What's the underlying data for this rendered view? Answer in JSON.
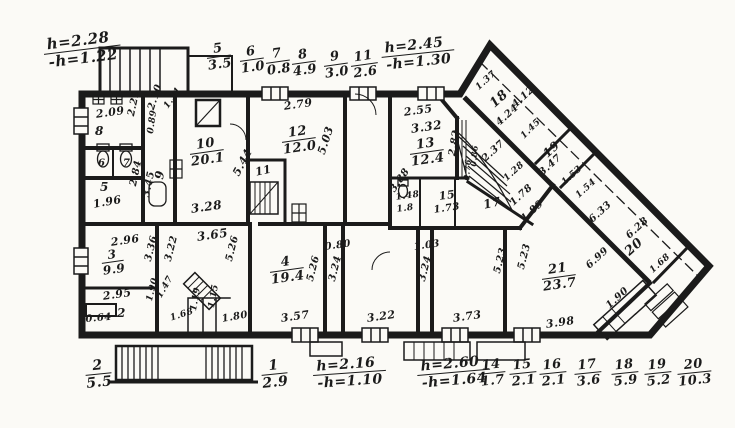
{
  "drawing": {
    "type": "apartment-floor-plan",
    "ink": "#1b1b1b",
    "paper": "#fbfaf6"
  },
  "room_fractions": [
    {
      "n": "5",
      "d": "3.5",
      "x": 205,
      "y": 44,
      "r": -8,
      "s": 13,
      "name": "legend-room-5"
    },
    {
      "n": "6",
      "d": "1.0",
      "x": 238,
      "y": 47,
      "r": -8,
      "s": 13,
      "name": "legend-room-6"
    },
    {
      "n": "7",
      "d": "0.8",
      "x": 264,
      "y": 49,
      "r": -8,
      "s": 13,
      "name": "legend-room-7"
    },
    {
      "n": "8",
      "d": "4.9",
      "x": 290,
      "y": 50,
      "r": -8,
      "s": 13,
      "name": "legend-room-8"
    },
    {
      "n": "9",
      "d": "3.0",
      "x": 322,
      "y": 52,
      "r": -8,
      "s": 13,
      "name": "legend-room-9"
    },
    {
      "n": "11",
      "d": "2.6",
      "x": 349,
      "y": 52,
      "r": -8,
      "s": 13,
      "name": "legend-room-11"
    },
    {
      "n": "h=2.28",
      "d": "-h=1.22",
      "x": 42,
      "y": 38,
      "r": -7,
      "s": 15,
      "cls": "h",
      "name": "height-note-top-left"
    },
    {
      "n": "h=2.45",
      "d": "-h=1.30",
      "x": 380,
      "y": 42,
      "r": -6,
      "s": 14,
      "cls": "h",
      "name": "height-note-top-right"
    },
    {
      "n": "2",
      "d": "5.5",
      "x": 84,
      "y": 360,
      "r": -6,
      "s": 14,
      "name": "legend-room-2"
    },
    {
      "n": "1",
      "d": "2.9",
      "x": 260,
      "y": 360,
      "r": -6,
      "s": 14,
      "name": "legend-room-1"
    },
    {
      "n": "h=2.16",
      "d": "-h=1.10",
      "x": 312,
      "y": 360,
      "r": -4,
      "s": 14,
      "cls": "h",
      "name": "height-note-bottom-left"
    },
    {
      "n": "h=2.60",
      "d": "-h=1.64",
      "x": 416,
      "y": 360,
      "r": -5,
      "s": 14,
      "cls": "h",
      "name": "height-note-bottom-right"
    },
    {
      "n": "14",
      "d": "1.7",
      "x": 477,
      "y": 360,
      "r": -6,
      "s": 13,
      "name": "legend-room-14"
    },
    {
      "n": "15",
      "d": "2.1",
      "x": 508,
      "y": 360,
      "r": -6,
      "s": 13,
      "name": "legend-room-15"
    },
    {
      "n": "16",
      "d": "2.1",
      "x": 538,
      "y": 360,
      "r": -6,
      "s": 13,
      "name": "legend-room-16"
    },
    {
      "n": "17",
      "d": "3.6",
      "x": 573,
      "y": 360,
      "r": -6,
      "s": 13,
      "name": "legend-room-17"
    },
    {
      "n": "18",
      "d": "5.9",
      "x": 610,
      "y": 360,
      "r": -6,
      "s": 13,
      "name": "legend-room-18"
    },
    {
      "n": "19",
      "d": "5.2",
      "x": 643,
      "y": 360,
      "r": -6,
      "s": 13,
      "name": "legend-room-19"
    },
    {
      "n": "20",
      "d": "10.3",
      "x": 676,
      "y": 360,
      "r": -6,
      "s": 13,
      "name": "legend-room-20"
    },
    {
      "n": "10",
      "d": "20.1",
      "x": 188,
      "y": 140,
      "r": -8,
      "s": 13,
      "name": "room-10-area"
    },
    {
      "n": "12",
      "d": "12.0",
      "x": 280,
      "y": 128,
      "r": -8,
      "s": 13,
      "name": "room-12-area"
    },
    {
      "n": "13",
      "d": "12.4",
      "x": 408,
      "y": 140,
      "r": -8,
      "s": 13,
      "name": "room-13-area"
    },
    {
      "n": "3",
      "d": "9.9",
      "x": 100,
      "y": 250,
      "r": -8,
      "s": 12,
      "name": "room-3-area"
    },
    {
      "n": "4",
      "d": "19.4",
      "x": 268,
      "y": 258,
      "r": -8,
      "s": 13,
      "name": "room-4-area"
    },
    {
      "n": "21",
      "d": "23.7",
      "x": 540,
      "y": 265,
      "r": -8,
      "s": 13,
      "name": "room-21-area"
    }
  ],
  "dim_labels": [
    {
      "t": "2.09",
      "x": 95,
      "y": 108,
      "r": -8,
      "s": 11
    },
    {
      "t": "8",
      "x": 95,
      "y": 124,
      "r": 0,
      "s": 12,
      "name": "room-8-label"
    },
    {
      "t": "2.29",
      "x": 126,
      "y": 115,
      "r": -78,
      "s": 10
    },
    {
      "t": "2.10",
      "x": 146,
      "y": 108,
      "r": -72,
      "s": 10
    },
    {
      "t": "1.31",
      "x": 162,
      "y": 105,
      "r": -55,
      "s": 9
    },
    {
      "t": "0.89",
      "x": 146,
      "y": 133,
      "r": -82,
      "s": 9
    },
    {
      "t": "9",
      "x": 152,
      "y": 178,
      "r": -80,
      "s": 12,
      "name": "room-9-label"
    },
    {
      "t": "3.45",
      "x": 141,
      "y": 196,
      "r": -78,
      "s": 10
    },
    {
      "t": "6",
      "x": 98,
      "y": 158,
      "r": 0,
      "s": 10,
      "name": "room-6-label"
    },
    {
      "t": "7",
      "x": 123,
      "y": 158,
      "r": 0,
      "s": 10,
      "name": "room-7-label"
    },
    {
      "t": "5",
      "x": 100,
      "y": 180,
      "r": 0,
      "s": 12,
      "name": "room-5-label"
    },
    {
      "t": "1.96",
      "x": 92,
      "y": 198,
      "r": -10,
      "s": 11
    },
    {
      "t": "2.84",
      "x": 128,
      "y": 185,
      "r": -78,
      "s": 10
    },
    {
      "t": "5.44",
      "x": 230,
      "y": 172,
      "r": -62,
      "s": 11
    },
    {
      "t": "3.28",
      "x": 190,
      "y": 202,
      "r": -8,
      "s": 12
    },
    {
      "t": "11",
      "x": 254,
      "y": 166,
      "r": -12,
      "s": 11,
      "name": "room-11-label"
    },
    {
      "t": "2.79",
      "x": 283,
      "y": 100,
      "r": -8,
      "s": 11
    },
    {
      "t": "5.03",
      "x": 315,
      "y": 152,
      "r": -72,
      "s": 11
    },
    {
      "t": "2.55",
      "x": 403,
      "y": 106,
      "r": -8,
      "s": 11
    },
    {
      "t": "3.32",
      "x": 410,
      "y": 122,
      "r": -8,
      "s": 12
    },
    {
      "t": "3.88",
      "x": 388,
      "y": 188,
      "r": -55,
      "s": 10
    },
    {
      "t": "2.82",
      "x": 447,
      "y": 155,
      "r": -80,
      "s": 10
    },
    {
      "t": "2.37",
      "x": 480,
      "y": 156,
      "r": -42,
      "s": 10
    },
    {
      "t": "0.86",
      "x": 468,
      "y": 166,
      "r": -85,
      "s": 8
    },
    {
      "t": "0.76",
      "x": 461,
      "y": 180,
      "r": -85,
      "s": 8
    },
    {
      "t": "1.28",
      "x": 502,
      "y": 176,
      "r": -42,
      "s": 9
    },
    {
      "t": "1.78",
      "x": 508,
      "y": 200,
      "r": -42,
      "s": 10
    },
    {
      "t": "1.45",
      "x": 519,
      "y": 134,
      "r": -45,
      "s": 9
    },
    {
      "t": "1.48",
      "x": 395,
      "y": 193,
      "r": -8,
      "s": 9
    },
    {
      "t": "1.8",
      "x": 396,
      "y": 205,
      "r": -8,
      "s": 9
    },
    {
      "t": "15",
      "x": 438,
      "y": 190,
      "r": -8,
      "s": 11,
      "name": "room-15-label"
    },
    {
      "t": "1.73",
      "x": 433,
      "y": 205,
      "r": -8,
      "s": 10
    },
    {
      "t": "17",
      "x": 482,
      "y": 198,
      "r": -12,
      "s": 12,
      "name": "room-17-label"
    },
    {
      "t": "1.37",
      "x": 474,
      "y": 85,
      "r": -42,
      "s": 9
    },
    {
      "t": "18",
      "x": 487,
      "y": 100,
      "r": -42,
      "s": 13,
      "name": "room-18-label"
    },
    {
      "t": "4.12",
      "x": 510,
      "y": 102,
      "r": -42,
      "s": 10
    },
    {
      "t": "4.24",
      "x": 494,
      "y": 120,
      "r": -42,
      "s": 10
    },
    {
      "t": "19",
      "x": 540,
      "y": 150,
      "r": -42,
      "s": 12,
      "name": "room-19-label"
    },
    {
      "t": "3.47",
      "x": 537,
      "y": 170,
      "r": -42,
      "s": 10
    },
    {
      "t": "1.53",
      "x": 560,
      "y": 180,
      "r": -42,
      "s": 9
    },
    {
      "t": "1.54",
      "x": 574,
      "y": 193,
      "r": -42,
      "s": 9
    },
    {
      "t": "6.33",
      "x": 587,
      "y": 217,
      "r": -42,
      "s": 10
    },
    {
      "t": "6.28",
      "x": 624,
      "y": 233,
      "r": -42,
      "s": 10
    },
    {
      "t": "20",
      "x": 622,
      "y": 248,
      "r": -42,
      "s": 13,
      "name": "room-20-label"
    },
    {
      "t": "6.99",
      "x": 584,
      "y": 263,
      "r": -42,
      "s": 10
    },
    {
      "t": "1.68",
      "x": 648,
      "y": 268,
      "r": -42,
      "s": 9
    },
    {
      "t": "1.90",
      "x": 604,
      "y": 303,
      "r": -42,
      "s": 10
    },
    {
      "t": "1.89",
      "x": 519,
      "y": 216,
      "r": -42,
      "s": 10
    },
    {
      "t": "3.98",
      "x": 545,
      "y": 318,
      "r": -8,
      "s": 11
    },
    {
      "t": "5.23",
      "x": 492,
      "y": 272,
      "r": -76,
      "s": 10
    },
    {
      "t": "5.23",
      "x": 516,
      "y": 268,
      "r": -76,
      "s": 10
    },
    {
      "t": "2.96",
      "x": 110,
      "y": 236,
      "r": -8,
      "s": 11
    },
    {
      "t": "3.36",
      "x": 143,
      "y": 260,
      "r": -76,
      "s": 10
    },
    {
      "t": "2.95",
      "x": 102,
      "y": 290,
      "r": -8,
      "s": 11
    },
    {
      "t": "2",
      "x": 117,
      "y": 306,
      "r": 0,
      "s": 12,
      "name": "room-2-label"
    },
    {
      "t": "0.64",
      "x": 85,
      "y": 314,
      "r": -5,
      "s": 10
    },
    {
      "t": "1.90",
      "x": 145,
      "y": 300,
      "r": -76,
      "s": 9
    },
    {
      "t": "3.22",
      "x": 163,
      "y": 260,
      "r": -76,
      "s": 10
    },
    {
      "t": "3.65",
      "x": 196,
      "y": 230,
      "r": -8,
      "s": 12
    },
    {
      "t": "5.26",
      "x": 224,
      "y": 260,
      "r": -76,
      "s": 10
    },
    {
      "t": "1.47",
      "x": 155,
      "y": 295,
      "r": -60,
      "s": 9
    },
    {
      "t": "1.68",
      "x": 169,
      "y": 314,
      "r": -18,
      "s": 9
    },
    {
      "t": "1.19",
      "x": 189,
      "y": 310,
      "r": -80,
      "s": 9
    },
    {
      "t": "1.15",
      "x": 207,
      "y": 307,
      "r": -80,
      "s": 9
    },
    {
      "t": "1.80",
      "x": 221,
      "y": 314,
      "r": -10,
      "s": 10
    },
    {
      "t": "5.26",
      "x": 305,
      "y": 280,
      "r": -76,
      "s": 10
    },
    {
      "t": "3.57",
      "x": 280,
      "y": 312,
      "r": -8,
      "s": 11
    },
    {
      "t": "0.80",
      "x": 324,
      "y": 242,
      "r": -8,
      "s": 10
    },
    {
      "t": "3.24",
      "x": 327,
      "y": 280,
      "r": -76,
      "s": 10
    },
    {
      "t": "3.22",
      "x": 366,
      "y": 312,
      "r": -8,
      "s": 11
    },
    {
      "t": "1.03",
      "x": 413,
      "y": 242,
      "r": -8,
      "s": 10
    },
    {
      "t": "3.24",
      "x": 417,
      "y": 280,
      "r": -76,
      "s": 10
    },
    {
      "t": "3.73",
      "x": 452,
      "y": 312,
      "r": -8,
      "s": 11
    }
  ]
}
